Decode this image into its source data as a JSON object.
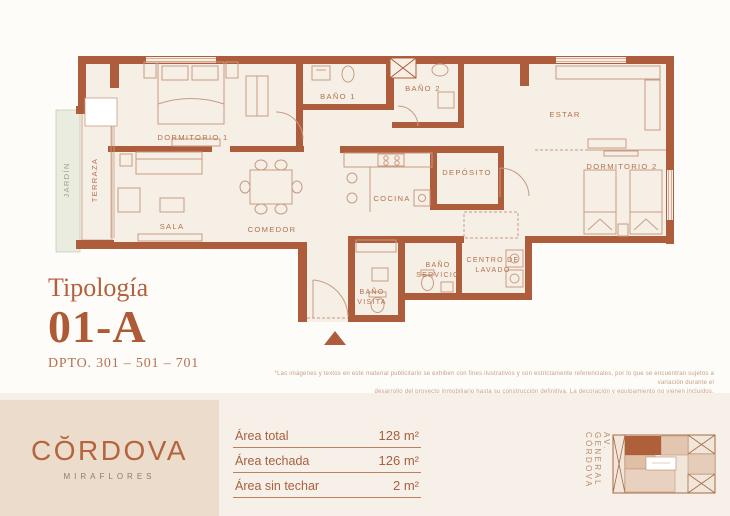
{
  "typology": {
    "label": "Tipología",
    "code": "01-A",
    "units": "DPTO. 301 – 501 – 701"
  },
  "floor_plan": {
    "rooms": {
      "dormitorio1": "DORMITORIO 1",
      "sala": "SALA",
      "comedor": "COMEDOR",
      "bano1": "BAÑO 1",
      "bano2": "BAÑO 2",
      "estar": "ESTAR",
      "dormitorio2": "DORMITORIO 2",
      "cocina": "COCINA",
      "deposito": "DEPÓSITO",
      "centro_lavado_l1": "CENTRO DE",
      "centro_lavado_l2": "LAVADO",
      "bano_servicio_l1": "BAÑO",
      "bano_servicio_l2": "SERVICIO",
      "bano_visita_l1": "BAÑO",
      "bano_visita_l2": "VISITA",
      "terraza": "TERRAZA",
      "jardin": "JARDÍN"
    }
  },
  "disclaimer": {
    "line1": "*Las imágenes y textos en este material publicitario se exhiben con fines ilustrativos y son estrictamente referenciales, por lo que se encuentran sujetos a variación durante el",
    "line2": "desarrollo del proyecto inmobiliario hasta su construcción definitiva. La decoración y equipamiento no vienen incluidos."
  },
  "brand": {
    "name": "CŎRDOVA",
    "tagline": "MIRAFLORES"
  },
  "areas": {
    "rows": [
      {
        "label": "Área total",
        "value": "128 m²"
      },
      {
        "label": "Área techada",
        "value": "126 m²"
      },
      {
        "label": "Área sin techar",
        "value": "2 m²"
      }
    ]
  },
  "map": {
    "street": "AV. GENERAL CÓRDOVA"
  },
  "colors": {
    "wall": "#ad5d3b",
    "accent": "#b2613c",
    "floor": "#f6efe6",
    "furniture_line": "#c99b82",
    "logo_box": "#ecdccb",
    "jardin": "#e9ecdf"
  }
}
